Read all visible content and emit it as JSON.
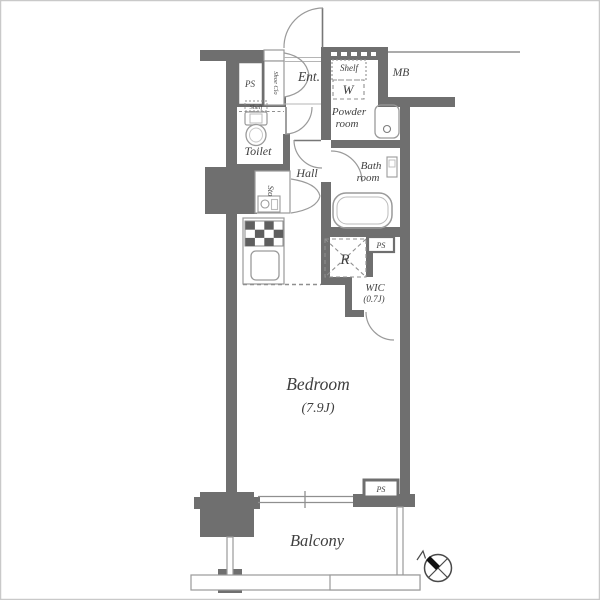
{
  "document": {
    "type": "apartment-floorplan"
  },
  "colors": {
    "wall": "#6f6f6f",
    "fixture_stroke": "#9a9a9a",
    "dash_stroke": "#8f8f8f",
    "text": "#3f3f3f",
    "frame": "#c9c9c9",
    "compass_needle": "#111111"
  },
  "labels": {
    "entrance": "Ent.",
    "shoe_closet": "Shoe Clo",
    "ps_top": "PS",
    "shelf_washer": "Shelf",
    "washer": "W",
    "meter_box": "MB",
    "powder_line1": "Powder",
    "powder_line2": "room",
    "toilet": "Toilet",
    "toilet_shelf": "Shelf",
    "hall": "Hall",
    "bath_line1": "Bath",
    "bath_line2": "room",
    "storage": "Sto",
    "refrigerator": "R",
    "ps_mid": "PS",
    "wic": "WIC",
    "wic_size": "(0.7J)",
    "bedroom": "Bedroom",
    "bedroom_size": "(7.9J)",
    "ps_bottom": "PS",
    "balcony": "Balcony"
  }
}
